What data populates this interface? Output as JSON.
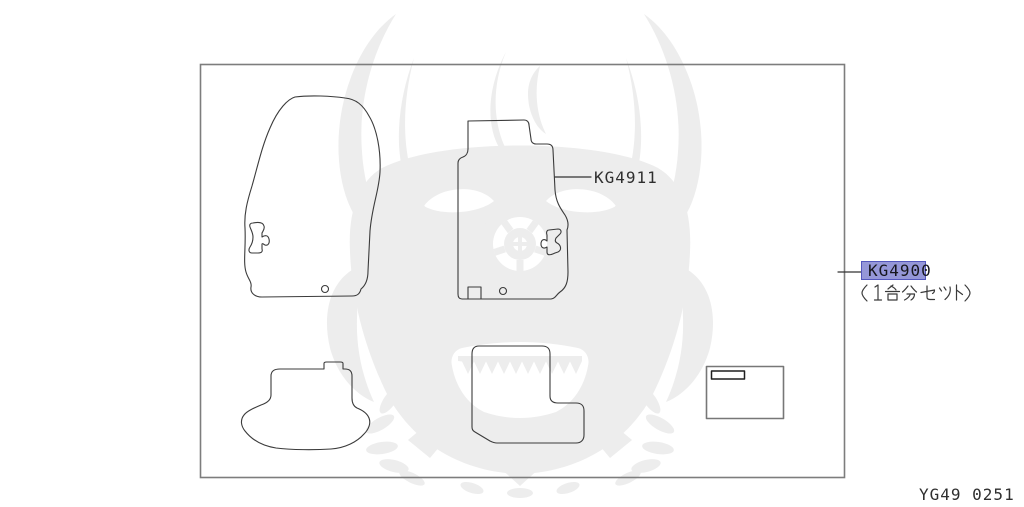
{
  "diagram": {
    "code": "YG49 0251",
    "callouts": {
      "kg4911": {
        "code": "KG4911",
        "highlighted": false
      },
      "kg4900": {
        "code": "KG4900",
        "highlighted": true,
        "note": "（1台分セット）"
      }
    }
  },
  "colors": {
    "background": "#ffffff",
    "line_art": "#3b3b3b",
    "frame_border": "#7d7d7d",
    "watermark": "#ededed",
    "highlight_fill": "#9597d8",
    "highlight_border": "#5457bd",
    "label_text": "#2f2f2f"
  },
  "icons": {
    "watermark": "samurai-mask-watermark-icon"
  }
}
